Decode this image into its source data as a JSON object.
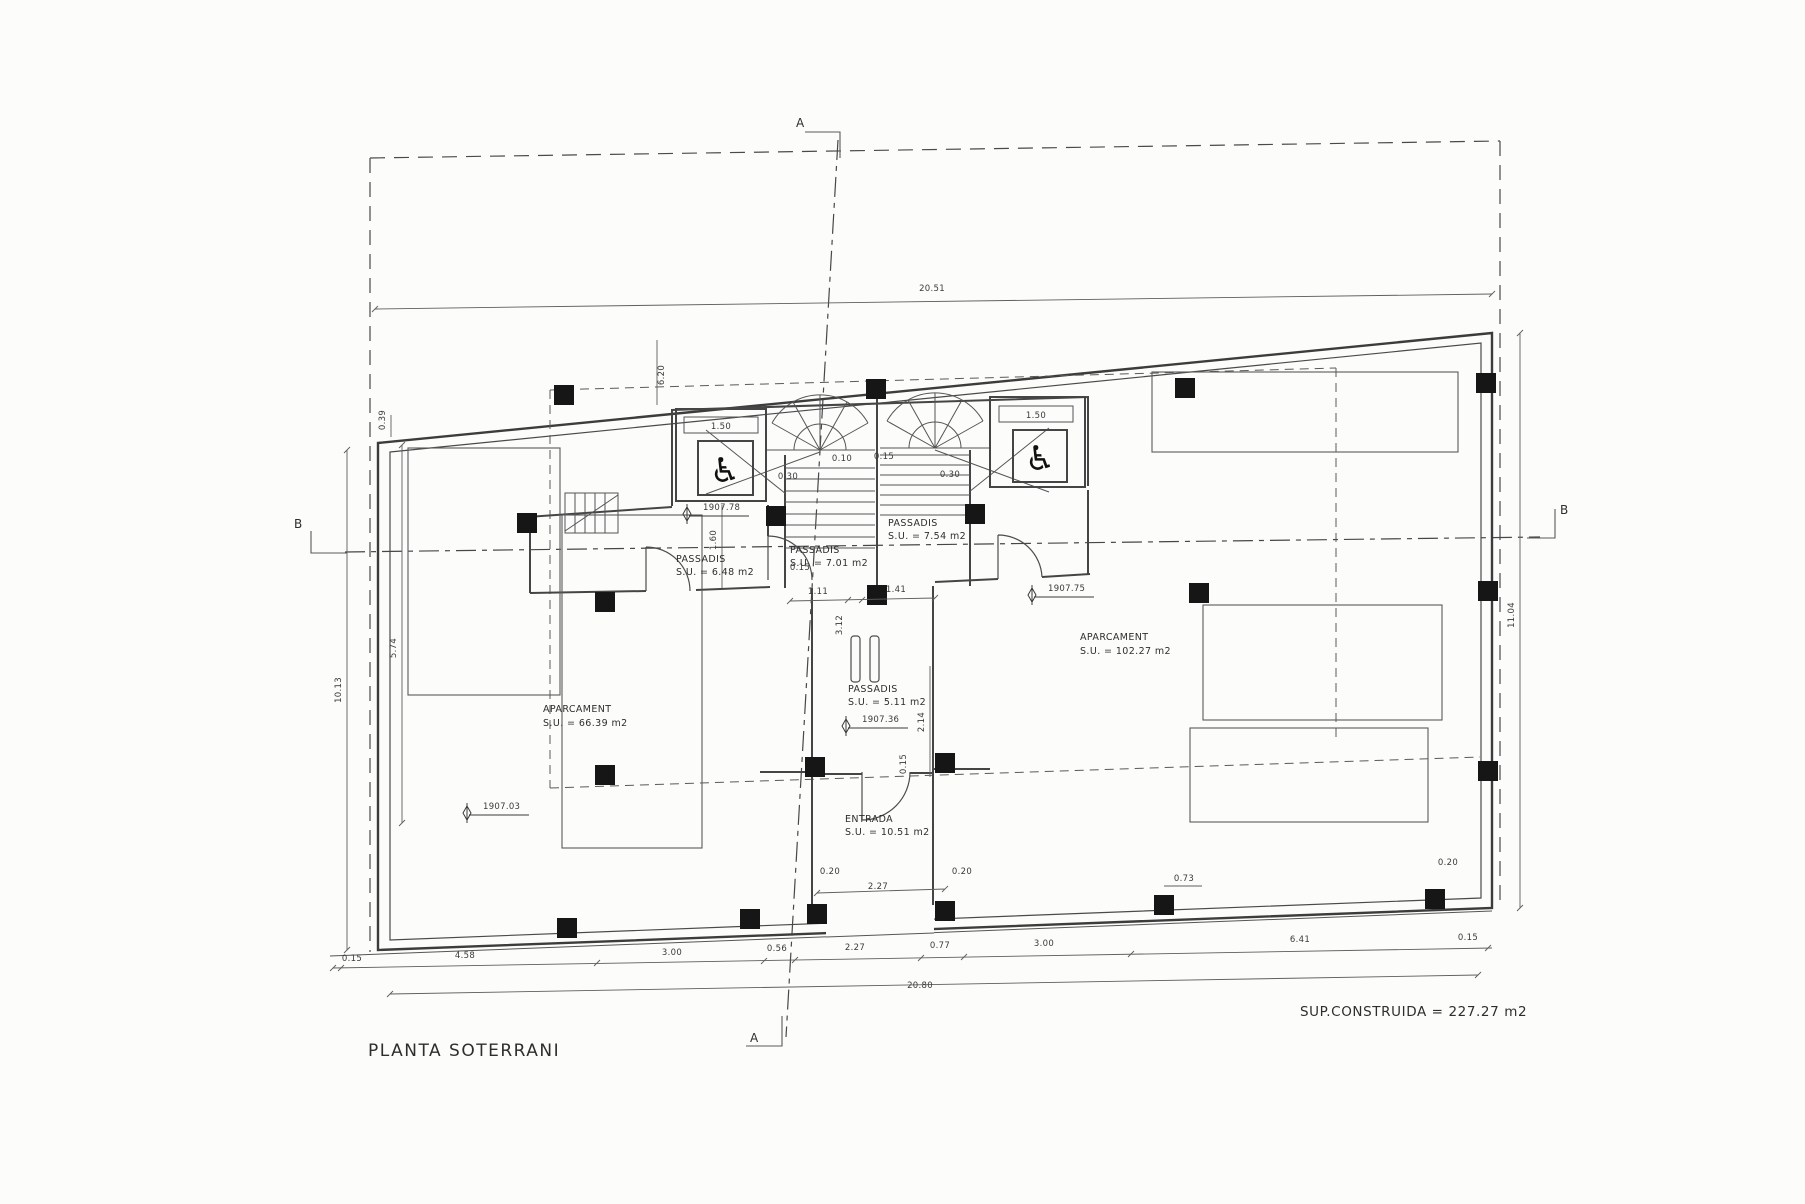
{
  "drawing": {
    "title": "PLANTA SOTERRANI",
    "area_note": "SUP.CONSTRUIDA = 227.27 m2",
    "sections": {
      "a": "A",
      "b": "B"
    },
    "rooms": {
      "passadis_left": {
        "name": "PASSADIS",
        "area": "S.U. = 6.48 m2"
      },
      "passadis_center": {
        "name": "PASSADIS",
        "area": "S.U. = 7.01 m2"
      },
      "passadis_right": {
        "name": "PASSADIS",
        "area": "S.U. = 7.54 m2"
      },
      "passadis_lower": {
        "name": "PASSADIS",
        "area": "S.U. = 5.11 m2"
      },
      "entrada": {
        "name": "ENTRADA",
        "area": "S.U. = 10.51 m2"
      },
      "aparcament_left": {
        "name": "APARCAMENT",
        "area": "S.U. = 66.39 m2"
      },
      "aparcament_right": {
        "name": "APARCAMENT",
        "area": "S.U. = 102.27 m2"
      }
    },
    "levels": {
      "near_elevator": "1907.78",
      "aparcament_right": "1907.75",
      "passadis_lower": "1907.36",
      "aparcament_left": "1907.03"
    },
    "dimensions": {
      "top_total": "20.51",
      "bottom_chain": [
        "0.15",
        "4.58",
        "3.00",
        "0.56",
        "2.27",
        "0.77",
        "3.00",
        "6.41",
        "0.15"
      ],
      "bottom_total": "20.80",
      "left_outer": "10.13",
      "left_inner": "5.74",
      "left_top_offset": "0.39",
      "right_outer": "11.04",
      "top_center_vert": "6.20",
      "elevator_left_width": "1.50",
      "elevator_right_width": "1.50",
      "corridor_left_width": "1.60",
      "stair_left_tread": "0.30",
      "stair_right_tread": "0.30",
      "stair_gap_1": "0.10",
      "stair_gap_2": "0.15",
      "hall_width_left": "1.11",
      "hall_width_right": "1.41",
      "hall_wall": "0.15",
      "hall_length": "3.12",
      "entrada_length": "2.14",
      "entrada_wall": "0.15",
      "entrada_jamb_left": "0.20",
      "entrada_jamb_right": "0.20",
      "entrada_width": "2.27",
      "kerb_right": "0.73",
      "corner_right_offset": "0.20"
    }
  },
  "icons": {
    "wheelchair": "♿"
  }
}
